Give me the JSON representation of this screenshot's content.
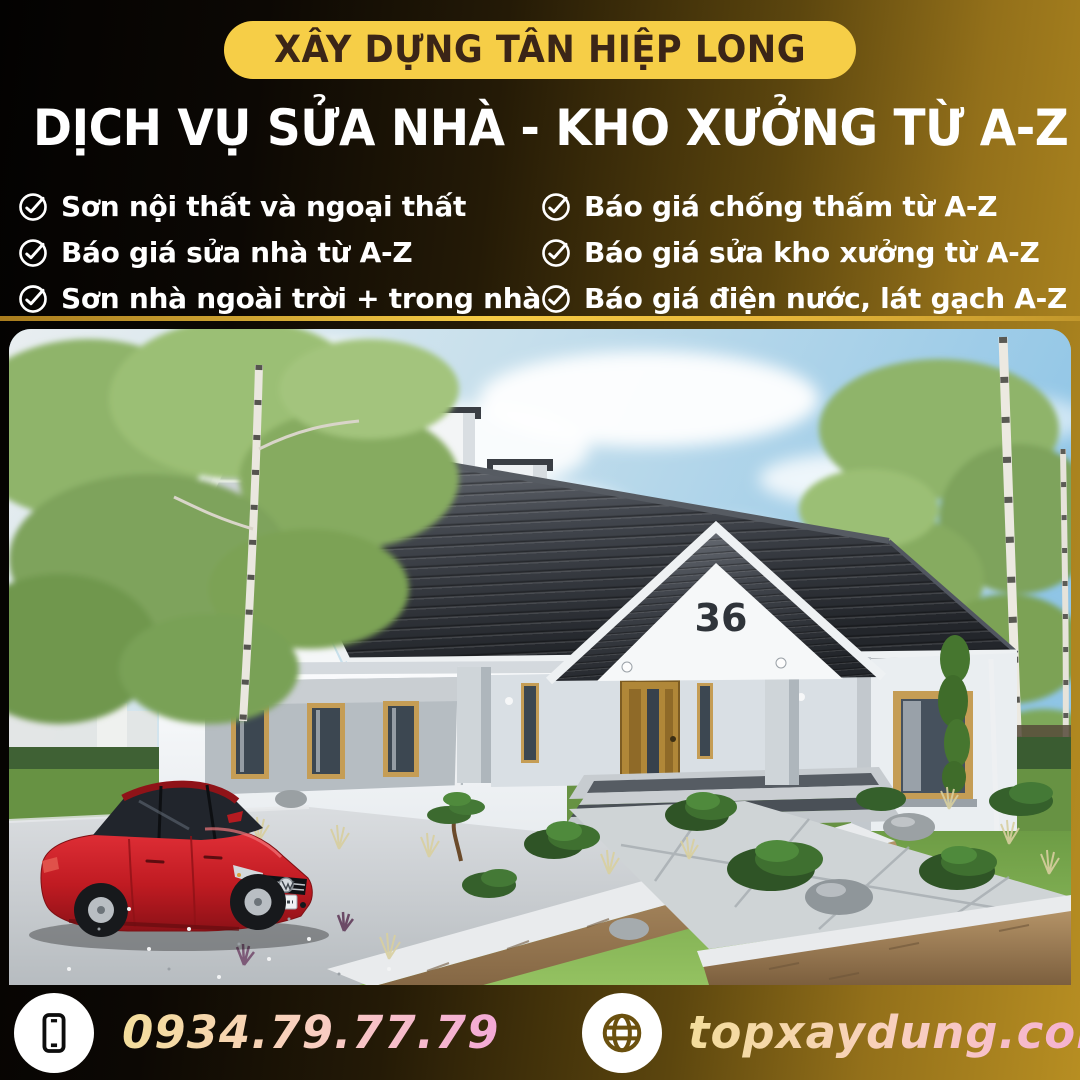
{
  "brand": {
    "badge": "XÂY DỰNG TÂN HIỆP LONG"
  },
  "heading": "DỊCH VỤ SỬA NHÀ - KHO XƯỞNG TỪ A-Z",
  "services": {
    "left": [
      "Sơn nội thất và ngoại thất",
      "Báo giá sửa nhà từ A-Z",
      "Sơn nhà ngoài trời + trong nhà"
    ],
    "right": [
      "Báo giá chống thấm từ A-Z",
      "Báo giá sửa kho xưởng từ A-Z",
      "Báo giá điện nước, lát gạch A-Z"
    ]
  },
  "photo": {
    "house_number": "36"
  },
  "footer": {
    "phone": "0934.79.77.79",
    "website": "topxaydung.com"
  },
  "icons": {
    "service_check": "check-circle-icon",
    "phone": "smartphone-icon",
    "website": "globe-icon"
  },
  "colors": {
    "badge_bg": "#F6CE47",
    "badge_text": "#3B2517",
    "gradient_black": "#050302",
    "gradient_gold": "#B78E22",
    "divider_gold": "#F6CB45",
    "heading_text": "#FFFFFF",
    "contact_text_start": "#F3DD9B",
    "contact_text_end": "#F4A9D6",
    "icon_circle_bg": "#FFFFFF"
  }
}
